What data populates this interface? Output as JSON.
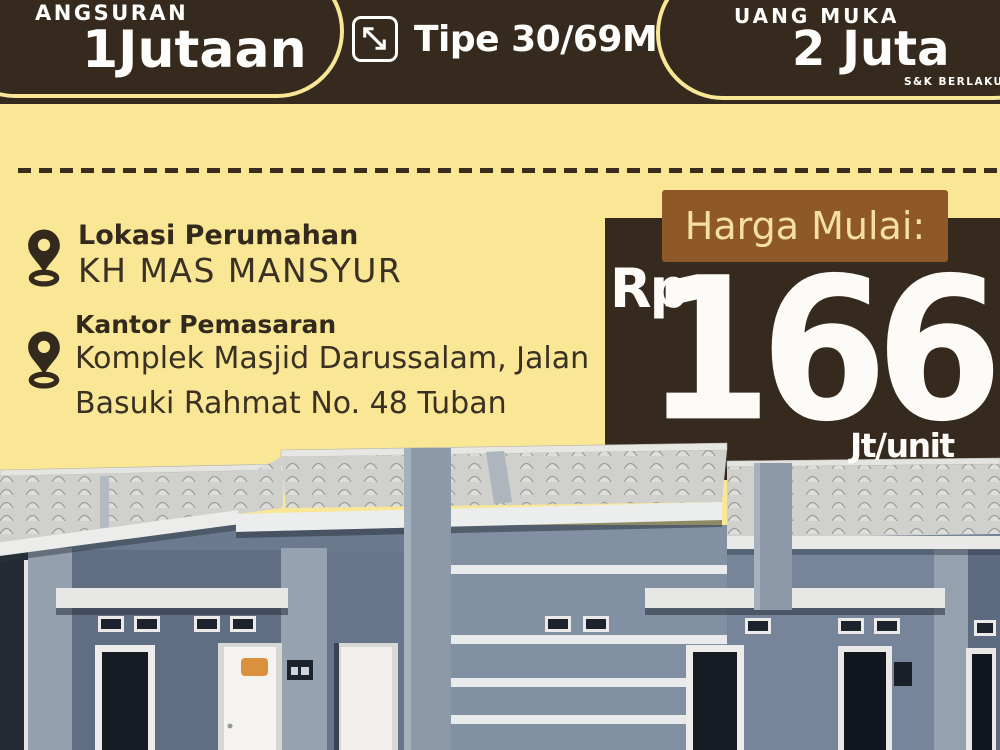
{
  "header": {
    "left_badge": {
      "top_label": "ANGSURAN",
      "main_label": "1Jutaan"
    },
    "type_spec": "Tipe 30/69M²",
    "right_badge": {
      "top_label": "UANG MUKA",
      "main_label": "2 Juta",
      "note": "S&K BERLAKU"
    }
  },
  "location": {
    "heading": "Lokasi Perumahan",
    "name": "KH MAS MANSYUR",
    "office_heading": "Kantor Pemasaran",
    "office_address_line1": "Komplek Masjid Darussalam, Jalan",
    "office_address_line2": "Basuki Rahmat No. 48 Tuban"
  },
  "price": {
    "label": "Harga Mulai:",
    "currency": "Rp",
    "amount": "166",
    "unit": "Jt/unit"
  },
  "colors": {
    "background_yellow": "#f9e795",
    "dark_brown": "#352a1d",
    "price_box_brown": "#8e5829",
    "price_label_cream": "#f6dfa2",
    "text_dark_brown": "#33291c",
    "text_white": "#fcfbf8",
    "house_wall_blue_gray": "#76859a",
    "roof_gray": "#d0d0cd"
  },
  "icons": {
    "dimension": "arrow-diagonal-icon",
    "location": "map-pin-icon"
  }
}
